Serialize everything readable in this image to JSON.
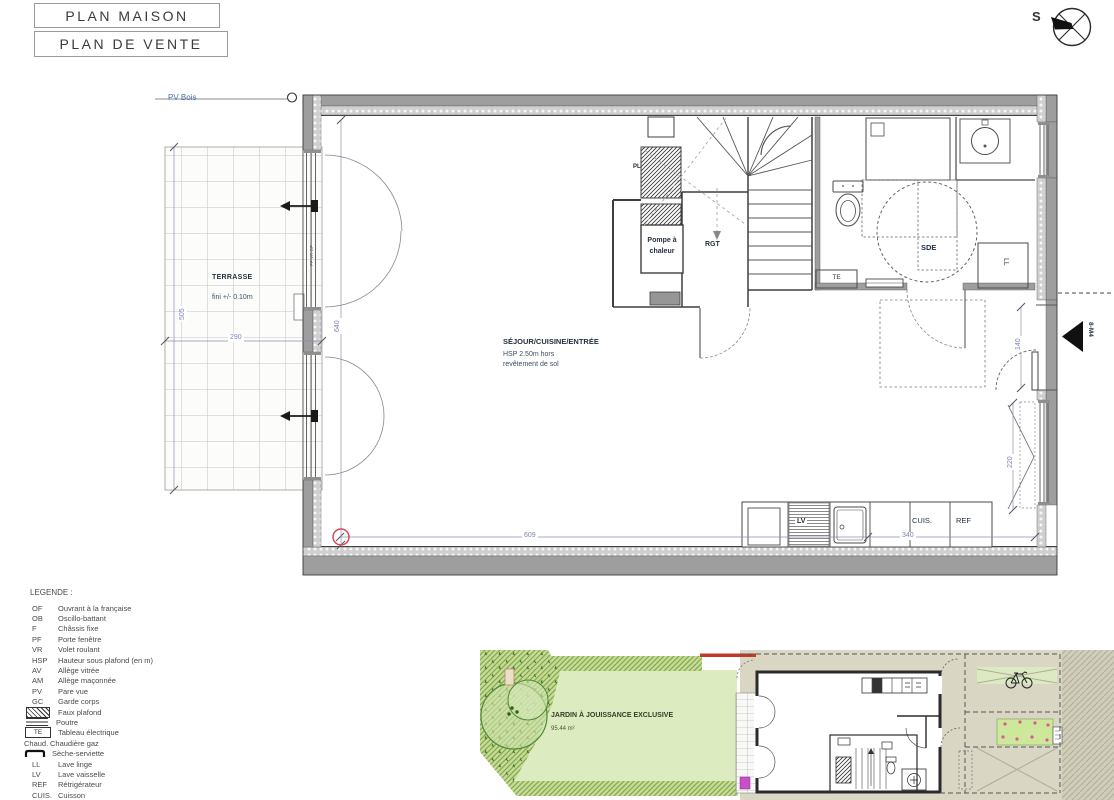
{
  "header": {
    "title1": "PLAN MAISON",
    "title2": "PLAN DE VENTE"
  },
  "compass": {
    "south_label": "S"
  },
  "plan": {
    "pv_bois": "PV Bois",
    "terrasse": {
      "title": "TERRASSE",
      "note": "fini +/- 0.10m"
    },
    "sejour": {
      "title": "SÉJOUR/CUISINE/ENTRÉE",
      "note1": "HSP 2.50m hors",
      "note2": "revêtement de sol"
    },
    "pompe_line1": "Pompe à",
    "pompe_line2": "chaleur",
    "rgt": "RGT",
    "sde": "SDE",
    "te": "TE",
    "ll": "LL",
    "lv": "LV",
    "cuis": "CUIS.",
    "ref": "REF",
    "pl": "PL",
    "marker_8m4": "8-M4",
    "window_note": "PF VR OF",
    "dims": {
      "terrasse_w": "290",
      "terrasse_h": "505",
      "left_h": "640",
      "bottom_left": "609",
      "bottom_right": "340",
      "right_door": "140",
      "right_window": "220"
    }
  },
  "legend": {
    "title": "LEGENDE :",
    "items": [
      {
        "abbr": "OF",
        "label": "Ouvrant à la française"
      },
      {
        "abbr": "OB",
        "label": "Oscillo-battant"
      },
      {
        "abbr": "F",
        "label": "Châssis fixe"
      },
      {
        "abbr": "PF",
        "label": "Porte fenêtre"
      },
      {
        "abbr": "VR",
        "label": "Volet roulant"
      },
      {
        "abbr": "HSP",
        "label": "Hauteur sous plafond (en m)"
      },
      {
        "abbr": "AV",
        "label": "Allège vitrée"
      },
      {
        "abbr": "AM",
        "label": "Allège maçonnée"
      },
      {
        "abbr": "PV",
        "label": "Pare vue"
      },
      {
        "abbr": "GC",
        "label": "Garde corps"
      },
      {
        "abbr": "",
        "label": "Faux plafond"
      },
      {
        "abbr": "",
        "label": "Poutre"
      },
      {
        "abbr": "TE",
        "label": "Tableau électrique"
      },
      {
        "abbr": "Chaud.",
        "label": "Chaudière gaz"
      },
      {
        "abbr": "",
        "label": "Sèche-serviette"
      },
      {
        "abbr": "LL",
        "label": "Lave linge"
      },
      {
        "abbr": "LV",
        "label": "Lave vaisselle"
      },
      {
        "abbr": "REF",
        "label": "Rétrigérateur"
      },
      {
        "abbr": "CUIS.",
        "label": "Cuisson"
      }
    ]
  },
  "siteplan": {
    "jardin_title": "JARDIN À JOUISSANCE EXCLUSIVE",
    "jardin_area": "95.44 m²"
  },
  "colors": {
    "dimension_blue": "#7C85B5",
    "label_navy": "#25313F",
    "annotation_blue": "#4A6FA8",
    "wall_gray": "#9E9E9E",
    "garden_green": "#DCECC0",
    "hatch_green": "#85A94E",
    "beige": "#D9D6C4",
    "pink_dot": "#E0559A",
    "magenta": "#C94FC9",
    "red_accent": "#C0392B",
    "red_circle": "#D5485C"
  }
}
